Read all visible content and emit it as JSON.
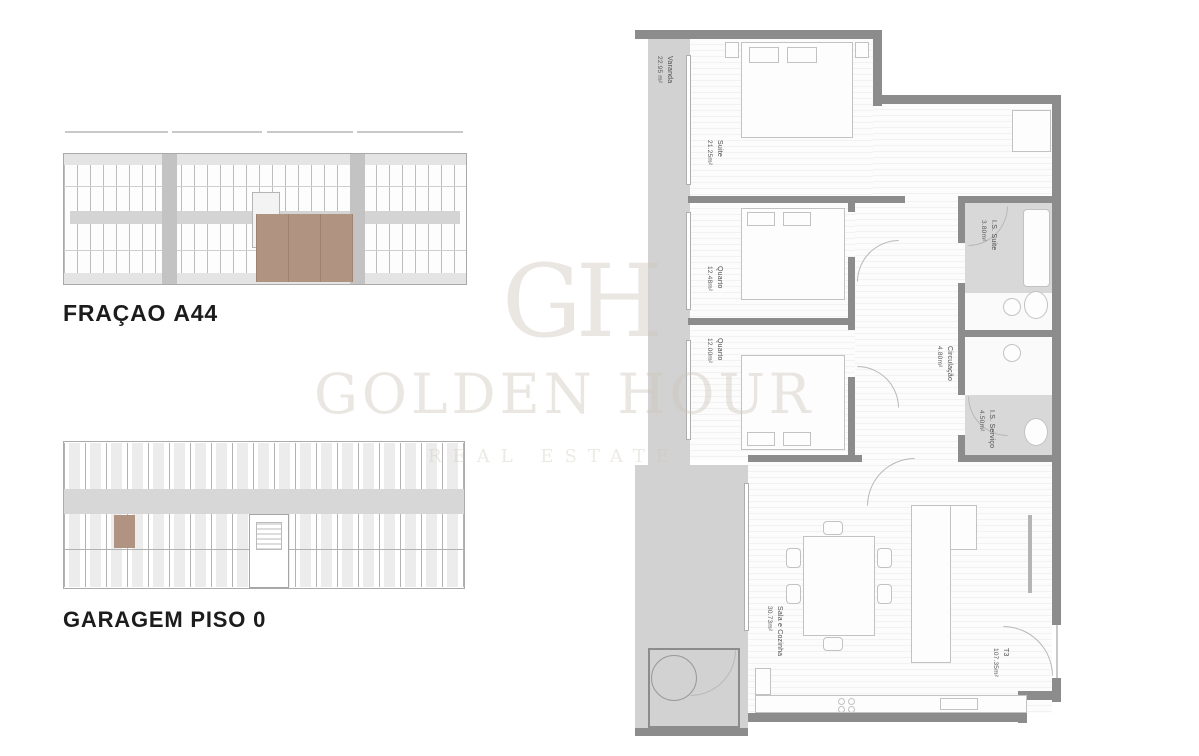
{
  "titles": {
    "fracao": {
      "prefix": "FRAÇAO ",
      "bold": "A44"
    },
    "garagem": {
      "prefix": "GARAGEM ",
      "bold": "PISO 0"
    }
  },
  "watermark": {
    "monogram": "GH",
    "name": "GOLDEN HOUR",
    "tagline": "REAL ESTATE"
  },
  "floor_plan": {
    "unit_type": "T3",
    "rooms": [
      {
        "name": "Varanda",
        "area": "22.95 m²"
      },
      {
        "name": "Suite",
        "area": "21.25m²"
      },
      {
        "name": "Quarto",
        "area": "12.48m²"
      },
      {
        "name": "Quarto",
        "area": "12.00m²"
      },
      {
        "name": "Circulação",
        "area": "4.80m²"
      },
      {
        "name": "I.S. Suite",
        "area": "3.80m²"
      },
      {
        "name": "I.S. Serviço",
        "area": "4.50m²"
      },
      {
        "name": "Sala e Cozinha",
        "area": "30.73m²"
      },
      {
        "name": "T3",
        "area": "107.35m²"
      }
    ]
  },
  "colors": {
    "highlight": "#b19382",
    "wall": "#8c8c8c",
    "terrace": "#d2d2d2"
  }
}
